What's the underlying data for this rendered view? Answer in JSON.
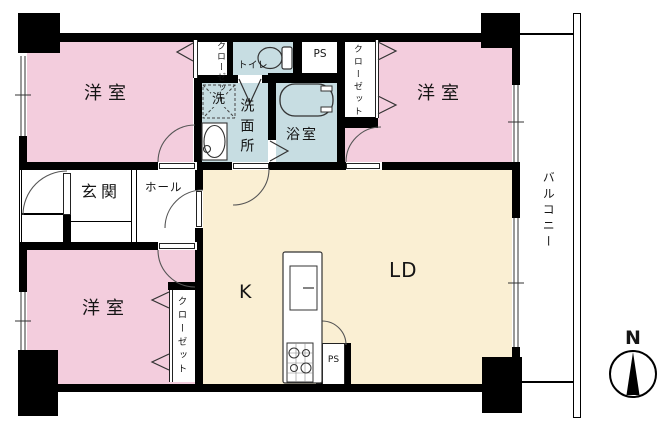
{
  "labels": {
    "bedroom": "洋室",
    "entrance": "玄関",
    "hall": "ホール",
    "toilet": "トイレ",
    "washroom": "洗面所",
    "bathroom": "浴室",
    "laundry": "洗",
    "kitchen": "K",
    "living_dining": "LD",
    "ps": "PS",
    "closet": "クローゼット",
    "balcony": "バルコニー",
    "north": "N"
  },
  "colors": {
    "bedroom_fill": "#f3cddd",
    "wet_area_fill": "#c7dde2",
    "ldk_fill": "#faefd3",
    "wall": "#000000",
    "background": "#ffffff"
  }
}
